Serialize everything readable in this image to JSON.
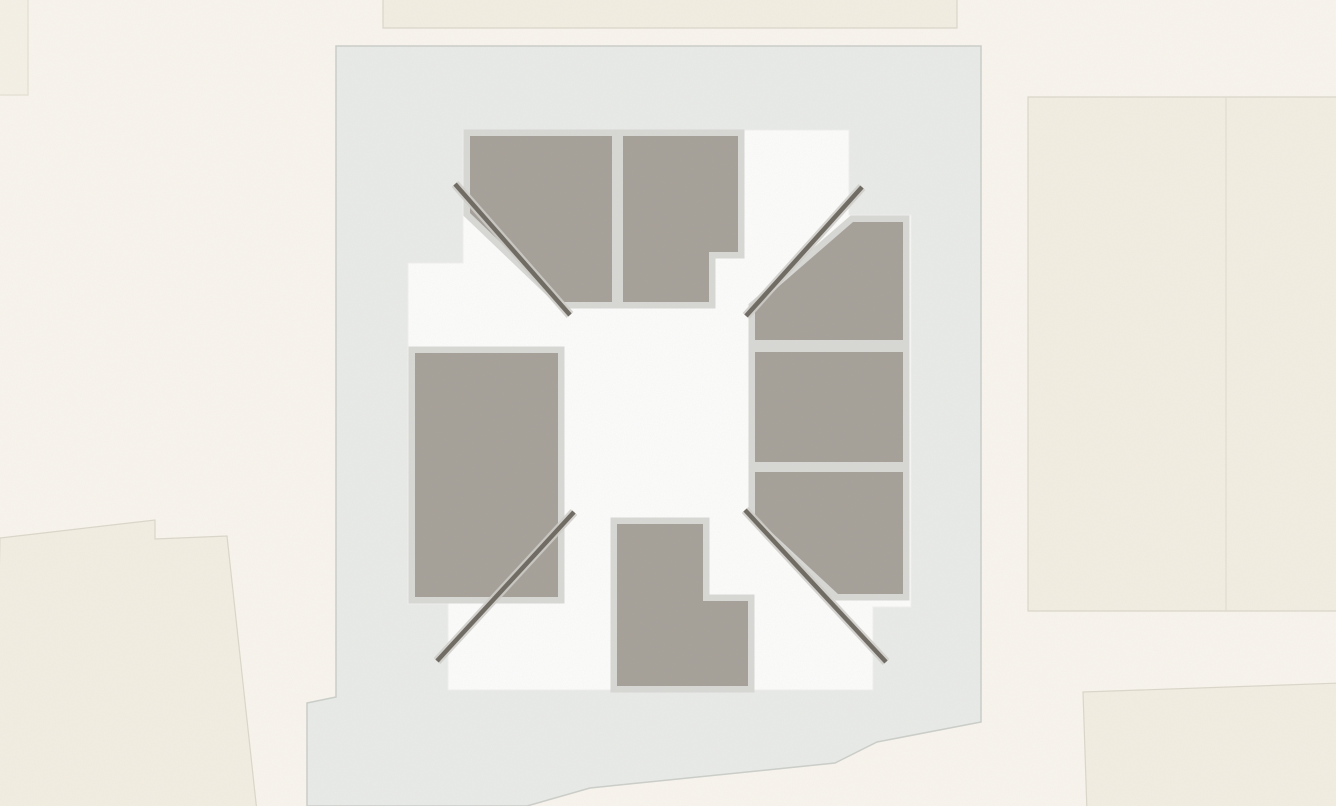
{
  "scene": {
    "kind": "architectural-site-plan",
    "visible_text": "",
    "elements": {
      "neighbor_buildings": [
        "top-strip",
        "top-left-corner",
        "right-large-parcel",
        "bottom-right-parcel",
        "bottom-left-parcel"
      ],
      "site": "light-gray-site-parcel",
      "building": "white-building-footprint-with-courtyard",
      "roof_panels": [
        "northwest",
        "north",
        "east-top",
        "east-middle",
        "east-bottom",
        "west",
        "south"
      ],
      "ridge_lines": [
        "northwest",
        "northeast",
        "southwest",
        "southeast"
      ]
    }
  },
  "colors": {
    "background": "#f9f5ee",
    "neighbor_fill": "#f3eee2",
    "neighbor_fill_soft": "#f5f1e7",
    "neighbor_edge": "#dbd7ca",
    "neighbor_divider": "#e3ded1",
    "site_fill": "#e9ebe8",
    "site_edge": "#cbcec9",
    "footprint_fill": "#fcfcfb",
    "footprint_edge": "#f0f0ee",
    "panel_fill": "#a5a098",
    "panel_border": "#d8d8d5",
    "ridge_dark": "#6e6a62",
    "ridge_light": "#d0cec9"
  }
}
